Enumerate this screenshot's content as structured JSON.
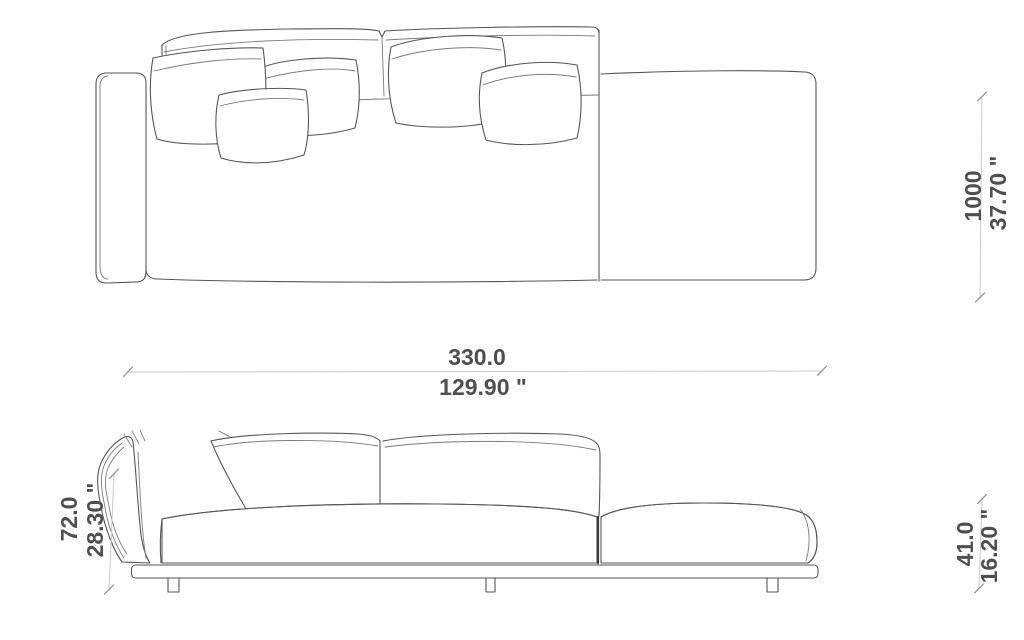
{
  "dimensions": {
    "width": {
      "primary": "330.0",
      "secondary": "129.90 \""
    },
    "depth": {
      "primary": "1000",
      "secondary": "37.70 \""
    },
    "back_height": {
      "primary": "72.0",
      "secondary": "28.30 \""
    },
    "seat_height": {
      "primary": "41.0",
      "secondary": "16.20 \""
    }
  },
  "colors": {
    "background": "#ffffff",
    "drawing_line": "#565656",
    "dimension_line": "#c9c9c9",
    "dimension_tick": "#9a9a9a",
    "dimension_text": "#4f4f4f"
  }
}
